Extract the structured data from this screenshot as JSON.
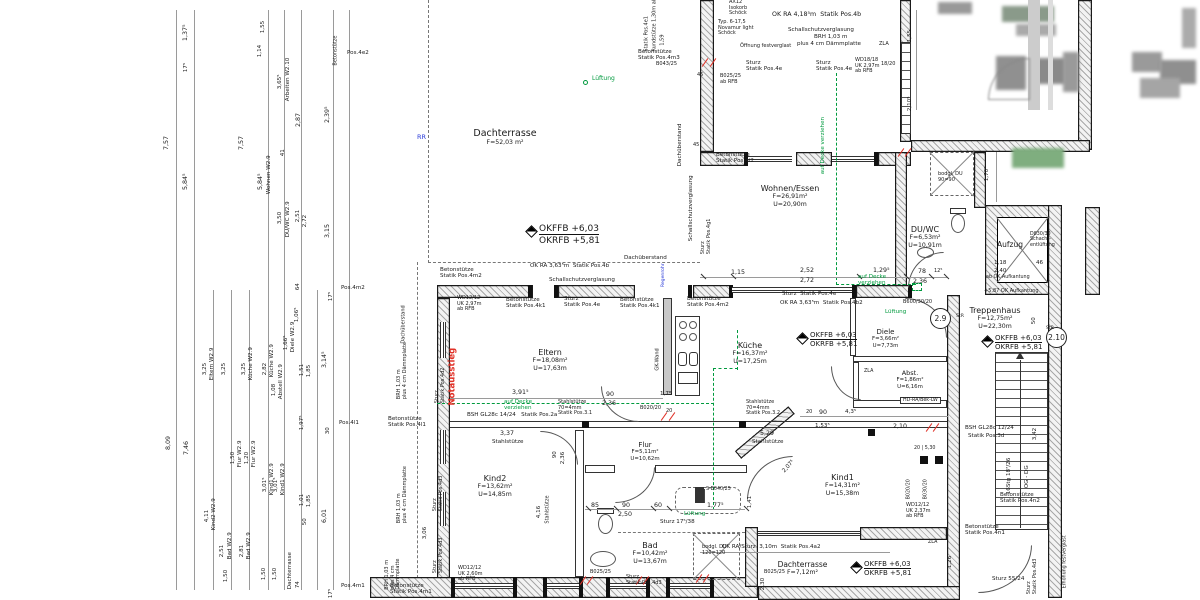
{
  "levels": {
    "ffb": "OKFFB +6,03",
    "rfb": "OKRFB +5,81"
  },
  "badges": [
    "2.9",
    "2.10"
  ],
  "colors": {
    "g": "#009a3e",
    "r": "#e03127",
    "b": "#2a3bd8",
    "k": "#1a1a1a"
  },
  "rooms": [
    {
      "name": "Dachterrasse",
      "area": "F=52,03 m²"
    },
    {
      "name": "Wohnen/Essen",
      "area": "F=26,91m²",
      "perim": "U=20,90m"
    },
    {
      "name": "DU/WC",
      "area": "F=6,53m²",
      "perim": "U=10,91m"
    },
    {
      "name": "Aufzug"
    },
    {
      "name": "Treppenhaus",
      "area": "F=12,75m²",
      "perim": "U=22,30m"
    },
    {
      "name": "Eltern",
      "area": "F=18,08m²",
      "perim": "U=17,63m"
    },
    {
      "name": "Küche",
      "area": "F=16,37m²",
      "perim": "U=17,25m"
    },
    {
      "name": "Diele",
      "area": "F=3,66m²",
      "perim": "U=7,73m"
    },
    {
      "name": "Abst.",
      "area": "F=1,86m²",
      "perim": "U=6,16m"
    },
    {
      "name": "Flur",
      "area": "F=5,11m²",
      "perim": "U=10,62m"
    },
    {
      "name": "Kind2",
      "area": "F=13,62m²",
      "perim": "U=14,85m"
    },
    {
      "name": "Kind1",
      "area": "F=14,31m²",
      "perim": "U=15,38m"
    },
    {
      "name": "Bad",
      "area": "F=10,42m²",
      "perim": "U=13,67m"
    },
    {
      "name": "Dachterrasse",
      "area": "F=7,12m²"
    }
  ],
  "annotations": [
    {
      "t": "7,57",
      "x": 170,
      "y": 143,
      "r": -90
    },
    {
      "t": "1,37⁵",
      "x": 189,
      "y": 34,
      "r": -90
    },
    {
      "t": "17⁵",
      "x": 189,
      "y": 66,
      "r": -90,
      "fs": 5.6
    },
    {
      "t": "5,84⁵",
      "x": 189,
      "y": 183,
      "r": -90
    },
    {
      "t": "7,57",
      "x": 245,
      "y": 143,
      "r": -90
    },
    {
      "t": "1,55",
      "x": 266,
      "y": 27,
      "r": -90,
      "fs": 5.6
    },
    {
      "t": "1,14",
      "x": 263,
      "y": 51,
      "r": -90,
      "fs": 5.6
    },
    {
      "t": "3,65⁵",
      "x": 283,
      "y": 83,
      "r": -90,
      "fs": 5.6
    },
    {
      "t": "Arbeiten W2.10",
      "x": 291,
      "y": 95,
      "r": -90,
      "fs": 5.6
    },
    {
      "t": "2,87",
      "x": 302,
      "y": 120,
      "r": -90
    },
    {
      "t": "2,39⁵",
      "x": 331,
      "y": 116,
      "r": -90
    },
    {
      "t": "41",
      "x": 286,
      "y": 150,
      "r": -90,
      "fs": 5.6
    },
    {
      "t": "Wohnen W2.9",
      "x": 272,
      "y": 188,
      "r": -90,
      "fs": 5.6
    },
    {
      "t": "5,84⁵",
      "x": 264,
      "y": 183,
      "r": -90
    },
    {
      "t": "3,50",
      "x": 283,
      "y": 218,
      "r": -90,
      "fs": 5.6
    },
    {
      "t": "DU/WC W2.9",
      "x": 291,
      "y": 231,
      "r": -90,
      "fs": 5.6
    },
    {
      "t": "2,51",
      "x": 301,
      "y": 216,
      "r": -90,
      "fs": 5.6
    },
    {
      "t": "2,72",
      "x": 308,
      "y": 221,
      "r": -90,
      "fs": 5.6
    },
    {
      "t": "3,15",
      "x": 331,
      "y": 231,
      "r": -90
    },
    {
      "t": "64",
      "x": 301,
      "y": 284,
      "r": -90,
      "fs": 5.6
    },
    {
      "t": "Betonstütze",
      "x": 339,
      "y": 60,
      "r": -90,
      "fs": 5
    },
    {
      "t": "Pos.4e2",
      "x": 347,
      "y": 50,
      "fs": 5.6
    },
    {
      "t": "8,09",
      "x": 172,
      "y": 443,
      "r": -90
    },
    {
      "t": "7,46",
      "x": 190,
      "y": 448,
      "r": -90
    },
    {
      "t": "3,25",
      "x": 208,
      "y": 369,
      "r": -90,
      "fs": 5.6
    },
    {
      "t": "Eltern W2.9",
      "x": 215,
      "y": 374,
      "r": -90,
      "fs": 5.6
    },
    {
      "t": "4,11",
      "x": 210,
      "y": 516,
      "r": -90,
      "fs": 5.6
    },
    {
      "t": "Kind2 W2.9",
      "x": 217,
      "y": 524,
      "r": -90,
      "fs": 5.6
    },
    {
      "t": "2,51",
      "x": 225,
      "y": 551,
      "r": -90,
      "fs": 5.6
    },
    {
      "t": "Bad W2.9",
      "x": 233,
      "y": 553,
      "r": -90,
      "fs": 5.6
    },
    {
      "t": "1,50",
      "x": 229,
      "y": 576,
      "r": -90,
      "fs": 5.6
    },
    {
      "t": "3,25",
      "x": 227,
      "y": 369,
      "r": -90,
      "fs": 5.6
    },
    {
      "t": "1,50",
      "x": 236,
      "y": 458,
      "r": -90,
      "fs": 5.6
    },
    {
      "t": "Flur W2.9",
      "x": 243,
      "y": 461,
      "r": -90,
      "fs": 5.6
    },
    {
      "t": "1,20",
      "x": 250,
      "y": 458,
      "r": -90,
      "fs": 5.6
    },
    {
      "t": "Flur W2.9",
      "x": 257,
      "y": 461,
      "r": -90,
      "fs": 5.6
    },
    {
      "t": "2,81",
      "x": 245,
      "y": 551,
      "r": -90,
      "fs": 5.6
    },
    {
      "t": "Bad W2.9",
      "x": 252,
      "y": 553,
      "r": -90,
      "fs": 5.6
    },
    {
      "t": "3,25",
      "x": 247,
      "y": 369,
      "r": -90,
      "fs": 5.6
    },
    {
      "t": "Küche W2.9",
      "x": 254,
      "y": 374,
      "r": -90,
      "fs": 5.6
    },
    {
      "t": "2,82",
      "x": 268,
      "y": 369,
      "r": -90,
      "fs": 5.6
    },
    {
      "t": "Küche W2.9",
      "x": 275,
      "y": 371,
      "r": -90,
      "fs": 5.6
    },
    {
      "t": "3,01⁵",
      "x": 268,
      "y": 486,
      "r": -90,
      "fs": 5.6
    },
    {
      "t": "Kind1 W2.9",
      "x": 275,
      "y": 489,
      "r": -90,
      "fs": 5.6
    },
    {
      "t": "3,01⁵",
      "x": 279,
      "y": 486,
      "r": -90,
      "fs": 5.6
    },
    {
      "t": "Kind1 W2.9",
      "x": 286,
      "y": 489,
      "r": -90,
      "fs": 5.6
    },
    {
      "t": "1,08",
      "x": 277,
      "y": 390,
      "r": -90,
      "fs": 5.6
    },
    {
      "t": "Abstell W2.9",
      "x": 284,
      "y": 393,
      "r": -90,
      "fs": 5.6
    },
    {
      "t": "1,66⁵",
      "x": 289,
      "y": 344,
      "r": -90,
      "fs": 5.6
    },
    {
      "t": "Diele W2.9",
      "x": 296,
      "y": 346,
      "r": -90,
      "fs": 5.6
    },
    {
      "t": "1,06⁵",
      "x": 300,
      "y": 316,
      "r": -90,
      "fs": 5.6
    },
    {
      "t": "1,51",
      "x": 305,
      "y": 370,
      "r": -90,
      "fs": 5.6
    },
    {
      "t": "1,85",
      "x": 312,
      "y": 371,
      "r": -90,
      "fs": 5.6
    },
    {
      "t": "1,97⁵",
      "x": 305,
      "y": 424,
      "r": -90,
      "fs": 5.6
    },
    {
      "t": "1,01",
      "x": 305,
      "y": 500,
      "r": -90,
      "fs": 5.6
    },
    {
      "t": "1,85",
      "x": 312,
      "y": 501,
      "r": -90,
      "fs": 5.6
    },
    {
      "t": "50",
      "x": 308,
      "y": 519,
      "r": -90,
      "fs": 5.6
    },
    {
      "t": "74",
      "x": 301,
      "y": 582,
      "r": -90,
      "fs": 5.6
    },
    {
      "t": "1,50",
      "x": 267,
      "y": 574,
      "r": -90,
      "fs": 5.6
    },
    {
      "t": "1,50",
      "x": 278,
      "y": 574,
      "r": -90,
      "fs": 5.6
    },
    {
      "t": "Dachterrasse",
      "x": 293,
      "y": 583,
      "r": -90,
      "fs": 5.6
    },
    {
      "t": "3,14⁵",
      "x": 328,
      "y": 361,
      "r": -90
    },
    {
      "t": "6,01",
      "x": 328,
      "y": 516,
      "r": -90
    },
    {
      "t": "30",
      "x": 331,
      "y": 428,
      "r": -90,
      "fs": 5.6
    },
    {
      "t": "Pos.4l1",
      "x": 339,
      "y": 420,
      "fs": 5.6
    },
    {
      "t": "17⁵",
      "x": 334,
      "y": 295,
      "r": -90,
      "fs": 5.6
    },
    {
      "t": "Pos.4m2",
      "x": 341,
      "y": 285,
      "fs": 5.6
    },
    {
      "t": "17⁵",
      "x": 334,
      "y": 592,
      "r": -90,
      "fs": 5.6
    },
    {
      "t": "Pos.4m1",
      "x": 341,
      "y": 583,
      "fs": 5.6
    },
    {
      "t": "OK RA 4,18⁵m  Statik Pos.4b",
      "x": 772,
      "y": 11
    },
    {
      "t": "Schallschutzverglasung",
      "x": 788,
      "y": 27,
      "fs": 5.6
    },
    {
      "t": "BRH 1,03 m",
      "x": 814,
      "y": 34,
      "fs": 5.6
    },
    {
      "t": "plus 4 cm Dämmplatte",
      "x": 797,
      "y": 41,
      "fs": 5.6
    },
    {
      "t": "Öffnung festverglast",
      "x": 740,
      "y": 44,
      "fs": 5
    },
    {
      "t": "Sturz\nStatik Pos.4e",
      "x": 746,
      "y": 60,
      "fs": 5.6
    },
    {
      "t": "Sturz\nStatik Pos.4e",
      "x": 816,
      "y": 60,
      "fs": 5.6
    },
    {
      "t": "WD18/18\nUK 2,97m\nab RFB",
      "x": 855,
      "y": 58,
      "fs": 5
    },
    {
      "t": "18/20",
      "x": 881,
      "y": 62,
      "fs": 5
    },
    {
      "t": "ZLA",
      "x": 879,
      "y": 42,
      "fs": 5
    },
    {
      "t": "AX12\nIsokorb\nSchöck",
      "x": 729,
      "y": 0,
      "fs": 5
    },
    {
      "t": "Typ. 6-17,5\nNovamur light\nSchöck",
      "x": 718,
      "y": 20,
      "fs": 5
    },
    {
      "t": "Betonstütze\nStatik Pos.4m3",
      "x": 638,
      "y": 49,
      "fs": 5.6
    },
    {
      "t": "B043/25",
      "x": 656,
      "y": 62,
      "fs": 5
    },
    {
      "t": "B025/25\nab RFB",
      "x": 720,
      "y": 74,
      "fs": 5
    },
    {
      "t": "45",
      "x": 697,
      "y": 73,
      "fs": 5
    },
    {
      "t": "Statik Pos.4e1",
      "x": 650,
      "y": 46,
      "r": -90,
      "fs": 5
    },
    {
      "t": "Rundstütze 1,30m ab RFB",
      "x": 658,
      "y": 46,
      "r": -90,
      "fs": 5
    },
    {
      "t": "1,59",
      "x": 666,
      "y": 40,
      "r": -90,
      "fs": 5
    },
    {
      "t": "Lüftung",
      "x": 592,
      "y": 76,
      "c": "g",
      "fs": 6
    },
    {
      "t": "RR",
      "x": 417,
      "y": 134,
      "c": "b",
      "fs": 6.5
    },
    {
      "t": "Dachüberstand",
      "x": 683,
      "y": 160,
      "r": -90,
      "fs": 5.6
    },
    {
      "t": "Betonstütze\nStatik Pos.4i2",
      "x": 716,
      "y": 152,
      "fs": 5.6
    },
    {
      "t": "Schallschutzverglasung",
      "x": 694,
      "y": 235,
      "r": -90,
      "fs": 5.6
    },
    {
      "t": "Sturz\nStatik Pos.4g1",
      "x": 712,
      "y": 243,
      "r": -90,
      "fs": 5
    },
    {
      "t": "45",
      "x": 693,
      "y": 143,
      "fs": 5
    },
    {
      "t": "1,15",
      "x": 731,
      "y": 269
    },
    {
      "t": "Dachüberstand",
      "x": 624,
      "y": 255,
      "fs": 5.6
    },
    {
      "t": "OK RA 3,63⁵m  Statik Pos.4b",
      "x": 530,
      "y": 263,
      "fs": 5.6
    },
    {
      "t": "Schallschutzverglasung",
      "x": 549,
      "y": 277,
      "fs": 5.6
    },
    {
      "t": "Betonstütze\nStatik Pos.4m2",
      "x": 440,
      "y": 267,
      "fs": 5.6
    },
    {
      "t": "2,52",
      "x": 800,
      "y": 267
    },
    {
      "t": "2,72",
      "x": 800,
      "y": 277
    },
    {
      "t": "1,29⁵",
      "x": 873,
      "y": 267
    },
    {
      "t": "78",
      "x": 918,
      "y": 268
    },
    {
      "t": "2,36",
      "x": 913,
      "y": 278
    },
    {
      "t": "12⁵",
      "x": 934,
      "y": 269,
      "fs": 5
    },
    {
      "t": "auf Decke\nverziehen",
      "x": 858,
      "y": 274,
      "c": "g",
      "fs": 5.6
    },
    {
      "t": "Lüftung",
      "x": 885,
      "y": 309,
      "c": "g",
      "fs": 5.6
    },
    {
      "t": "auf Decke verziehen",
      "x": 826,
      "y": 168,
      "r": -90,
      "c": "g",
      "fs": 5.6
    },
    {
      "t": "Sturz  Statik Pos.4e",
      "x": 782,
      "y": 291,
      "fs": 5.6
    },
    {
      "t": "OK RA 3,63⁵m  Statik Pos.4b2",
      "x": 780,
      "y": 300,
      "fs": 5.6
    },
    {
      "t": "B600/30/20",
      "x": 903,
      "y": 300,
      "fs": 5
    },
    {
      "t": "WD12/12\nUK 2,97m\nab RFB",
      "x": 457,
      "y": 296,
      "fs": 5
    },
    {
      "t": "Betonstütze\nStatik Pos.4k1",
      "x": 506,
      "y": 297,
      "fs": 5.6
    },
    {
      "t": "Sturz\nStatik Pos.4e",
      "x": 564,
      "y": 296,
      "fs": 5.6
    },
    {
      "t": "Betonstütze\nStatik Pos.4k1",
      "x": 620,
      "y": 297,
      "fs": 5.6
    },
    {
      "t": "Betonstütze\nStatik Pos.4m2",
      "x": 687,
      "y": 296,
      "fs": 5.6
    },
    {
      "t": "Notausstieg",
      "x": 458,
      "y": 396,
      "r": -90,
      "c": "r",
      "fs": 8.5,
      "b": 1
    },
    {
      "t": "Sturz\nStatik Pos.4d2",
      "x": 446,
      "y": 392,
      "r": -90,
      "fs": 5
    },
    {
      "t": "GK-Wand",
      "x": 661,
      "y": 365,
      "r": -90,
      "fs": 5
    },
    {
      "t": "3,91⁵",
      "x": 512,
      "y": 389
    },
    {
      "t": "90",
      "x": 606,
      "y": 391
    },
    {
      "t": "2,36",
      "x": 602,
      "y": 400
    },
    {
      "t": "1,75",
      "x": 660,
      "y": 391,
      "fs": 5.6
    },
    {
      "t": "BSH GL28c 14/24   Statik Pos.2a",
      "x": 467,
      "y": 412,
      "fs": 5.6
    },
    {
      "t": "Stahlstütze\n70=4mm\nStatik Pos.3.1",
      "x": 558,
      "y": 400,
      "fs": 5
    },
    {
      "t": "Stahlstütze\n70=4mm\nStatik Pos.3.2",
      "x": 746,
      "y": 400,
      "fs": 5
    },
    {
      "t": "B020/20",
      "x": 640,
      "y": 406,
      "fs": 5
    },
    {
      "t": "20",
      "x": 666,
      "y": 409,
      "fs": 5
    },
    {
      "t": "3,37",
      "x": 500,
      "y": 430
    },
    {
      "t": "Stahlstütze",
      "x": 492,
      "y": 439,
      "fs": 5.6
    },
    {
      "t": "5,29",
      "x": 760,
      "y": 430
    },
    {
      "t": "Stahlstütze",
      "x": 752,
      "y": 439,
      "fs": 5.6
    },
    {
      "t": "auf Decke\nverziehen",
      "x": 504,
      "y": 399,
      "c": "g",
      "fs": 5.6
    },
    {
      "t": "90",
      "x": 819,
      "y": 409
    },
    {
      "t": "4,3⁵",
      "x": 845,
      "y": 409,
      "fs": 5.6
    },
    {
      "t": "20",
      "x": 806,
      "y": 410,
      "fs": 5
    },
    {
      "t": "1,53⁵",
      "x": 815,
      "y": 423,
      "fs": 5.6
    },
    {
      "t": "2,10",
      "x": 893,
      "y": 423
    },
    {
      "t": "HD-RA/Bek-LW",
      "x": 900,
      "y": 397,
      "fs": 4.8,
      "bx": 1
    },
    {
      "t": "StR",
      "x": 956,
      "y": 314,
      "fs": 4.6
    },
    {
      "t": "StR",
      "x": 1046,
      "y": 326,
      "fs": 4.6
    },
    {
      "t": "1,41",
      "x": 753,
      "y": 502,
      "r": -90,
      "fs": 5.6
    },
    {
      "t": "2,07⁵",
      "x": 786,
      "y": 468,
      "r": -48,
      "fs": 5.6
    },
    {
      "t": "85",
      "x": 591,
      "y": 502
    },
    {
      "t": "90",
      "x": 622,
      "y": 502
    },
    {
      "t": "2,50",
      "x": 618,
      "y": 511
    },
    {
      "t": "60",
      "x": 654,
      "y": 502
    },
    {
      "t": "1,77⁵",
      "x": 707,
      "y": 502
    },
    {
      "t": "S-B040/25",
      "x": 706,
      "y": 487,
      "fs": 4.8
    },
    {
      "t": "Lüftung",
      "x": 684,
      "y": 511,
      "c": "g",
      "fs": 5.6
    },
    {
      "t": "4,16",
      "x": 542,
      "y": 512,
      "r": -90,
      "fs": 5.6
    },
    {
      "t": "Stahlstütze",
      "x": 551,
      "y": 518,
      "r": -90,
      "fs": 5
    },
    {
      "t": "3,06",
      "x": 428,
      "y": 533,
      "r": -90,
      "fs": 5.6
    },
    {
      "t": "90",
      "x": 558,
      "y": 452,
      "r": -90,
      "fs": 5.6
    },
    {
      "t": "2,36",
      "x": 566,
      "y": 458,
      "r": -90,
      "fs": 5.6
    },
    {
      "t": "Sturz\nStatik Pos.4d3",
      "x": 444,
      "y": 500,
      "r": -90,
      "fs": 5
    },
    {
      "t": "Sturz\nStatik Pos.4d3",
      "x": 444,
      "y": 562,
      "r": -90,
      "fs": 5
    },
    {
      "t": "WD12/12\nUK 2,60m\nab RFB",
      "x": 458,
      "y": 566,
      "fs": 5
    },
    {
      "t": "B025/25",
      "x": 590,
      "y": 570,
      "fs": 5
    },
    {
      "t": "B025/25",
      "x": 764,
      "y": 570,
      "fs": 5
    },
    {
      "t": "Sturz\nStatik Pos.4d3",
      "x": 626,
      "y": 575,
      "fs": 5
    },
    {
      "t": "Betonstütze\nStatik Pos.4m1",
      "x": 390,
      "y": 583,
      "fs": 5.6
    },
    {
      "t": "BRH 1,03 m\nplus 4 cm\nDämmplatte",
      "x": 402,
      "y": 573,
      "r": -90,
      "fs": 5
    },
    {
      "t": "BRH 1,03 m\nplus 4 cm Dämmplatte",
      "x": 408,
      "y": 388,
      "r": -90,
      "fs": 5
    },
    {
      "t": "BRH 1,03 m\nplus 4 cm Dämmplatte",
      "x": 408,
      "y": 512,
      "r": -90,
      "fs": 5
    },
    {
      "t": "Dachüberstand",
      "x": 407,
      "y": 338,
      "r": -90,
      "fs": 5
    },
    {
      "t": "Betonstütze\nStatik Pos.4l1",
      "x": 388,
      "y": 416,
      "fs": 5.6
    },
    {
      "t": "bodgl. DU\n120=120",
      "x": 702,
      "y": 545,
      "fs": 5
    },
    {
      "t": "bodgl. DU\n90=90",
      "x": 938,
      "y": 172,
      "fs": 5
    },
    {
      "t": "Sturz 17⁵/38",
      "x": 660,
      "y": 519,
      "fs": 5.6
    },
    {
      "t": "OK RA/Sturz  3,10m  Statik Pos.4a2",
      "x": 722,
      "y": 544,
      "fs": 5.6
    },
    {
      "t": "WD12/12\nUK 2,37m\nab RFB",
      "x": 906,
      "y": 503,
      "fs": 5
    },
    {
      "t": "20 | 5,30",
      "x": 914,
      "y": 446,
      "fs": 4.8
    },
    {
      "t": "B020/20",
      "x": 912,
      "y": 494,
      "r": -90,
      "fs": 4.8
    },
    {
      "t": "B030/20",
      "x": 929,
      "y": 494,
      "r": -90,
      "fs": 4.8
    },
    {
      "t": "Sturz 55/24",
      "x": 992,
      "y": 576,
      "fs": 5.6
    },
    {
      "t": "Betonstütze\nStatik Pos.4n2",
      "x": 1000,
      "y": 492,
      "fs": 5.6
    },
    {
      "t": "Betonstütze\nStatik Pos.4n1",
      "x": 965,
      "y": 524,
      "fs": 5.6
    },
    {
      "t": "BSH GL28c 12/24",
      "x": 965,
      "y": 425,
      "fs": 5.6
    },
    {
      "t": "Statik Pos.3d",
      "x": 968,
      "y": 433,
      "fs": 5.6
    },
    {
      "t": "16Stg 18⁷/26",
      "x": 1012,
      "y": 488,
      "r": -90,
      "fs": 5.6
    },
    {
      "t": "OG - DG",
      "x": 1030,
      "y": 482,
      "r": -90,
      "fs": 5.6
    },
    {
      "t": "3,42",
      "x": 1038,
      "y": 434,
      "r": -90,
      "fs": 5.6
    },
    {
      "t": "1,26",
      "x": 953,
      "y": 562,
      "r": -90,
      "fs": 5.6
    },
    {
      "t": "Sturz\nStatik Pos.4d3",
      "x": 1038,
      "y": 583,
      "r": -90,
      "fs": 5
    },
    {
      "t": "Erhöhung festverglast",
      "x": 1068,
      "y": 583,
      "r": -90,
      "fs": 4.8
    },
    {
      "t": "ZLA",
      "x": 928,
      "y": 540,
      "fs": 4.8
    },
    {
      "t": "+5,87 OK Aufkantung",
      "x": 984,
      "y": 289,
      "fs": 5
    },
    {
      "t": "1,18",
      "x": 994,
      "y": 260,
      "fs": 5.6
    },
    {
      "t": "2,40",
      "x": 994,
      "y": 268,
      "fs": 5.6
    },
    {
      "t": "ab OK Aufkantung",
      "x": 986,
      "y": 275,
      "fs": 4.8
    },
    {
      "t": "46",
      "x": 1036,
      "y": 260,
      "fs": 5.6
    },
    {
      "t": "D830/30\nSchacht-\nentlüftung",
      "x": 1030,
      "y": 232,
      "fs": 4.8
    },
    {
      "t": "1,55",
      "x": 913,
      "y": 36,
      "r": -90,
      "fs": 5.6
    },
    {
      "t": "2,10⁵",
      "x": 913,
      "y": 105,
      "r": -90,
      "fs": 5.6
    },
    {
      "t": "1,70⁵",
      "x": 990,
      "y": 175,
      "r": -90,
      "fs": 5.6
    },
    {
      "t": "50",
      "x": 1037,
      "y": 318,
      "r": -90,
      "fs": 5.6
    },
    {
      "t": "2,30",
      "x": 766,
      "y": 584,
      "r": -90,
      "fs": 5.6
    },
    {
      "t": "Regenrohr",
      "x": 666,
      "y": 282,
      "r": -90,
      "c": "b",
      "fs": 4.6
    },
    {
      "t": "ZLA",
      "x": 864,
      "y": 369,
      "fs": 4.8
    }
  ]
}
